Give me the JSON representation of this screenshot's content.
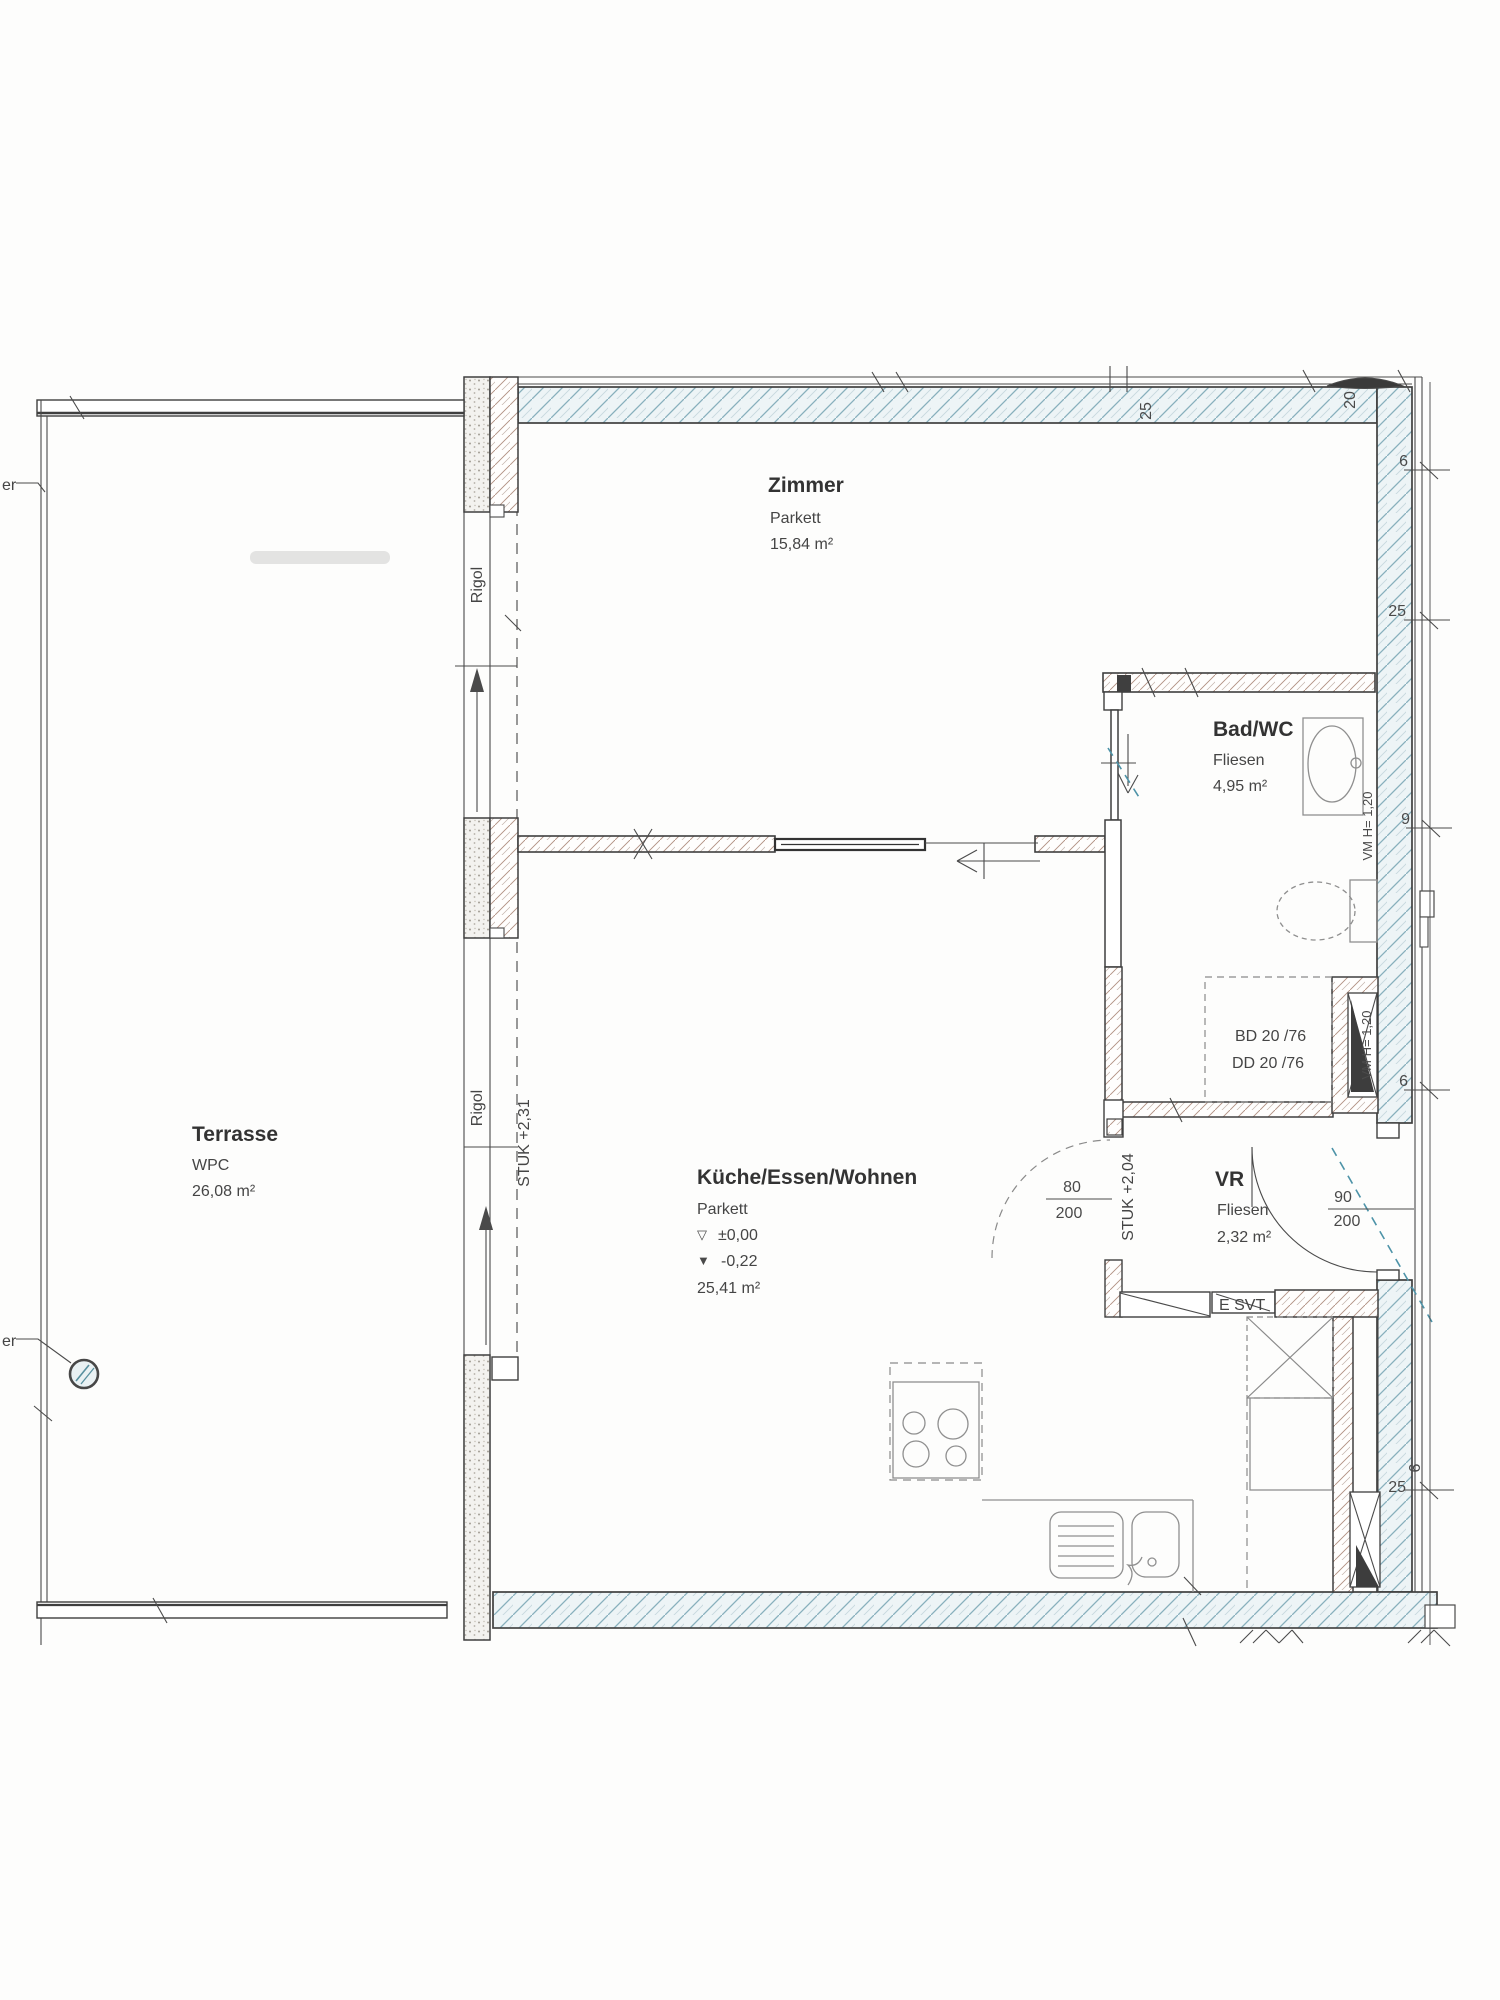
{
  "rooms": {
    "zimmer": {
      "name": "Zimmer",
      "floor": "Parkett",
      "area": "15,84 m²"
    },
    "bad_wc": {
      "name": "Bad/WC",
      "floor": "Fliesen",
      "area": "4,95 m²"
    },
    "terrasse": {
      "name": "Terrasse",
      "floor": "WPC",
      "area": "26,08 m²"
    },
    "kueche": {
      "name": "Küche/Essen/Wohnen",
      "floor": "Parkett",
      "level_symbol_top": "▽",
      "level_top": "±0,00",
      "level_symbol_bottom": "▼",
      "level_bottom": "-0,22",
      "area": "25,41 m²"
    },
    "vr": {
      "name": "VR",
      "floor": "Fliesen",
      "area": "2,32 m²"
    }
  },
  "doors": {
    "vr_west": {
      "width": "80",
      "height": "200"
    },
    "entrance": {
      "width": "90",
      "height": "200"
    }
  },
  "annotations": {
    "rigol_upper": "Rigol",
    "rigol_lower": "Rigol",
    "stuk_facade": "STUK +2,31",
    "stuk_vr": "STUK +2,04",
    "vm_niche": "VM H= 1,20",
    "vm_shaft": "VM H= 1,20",
    "tub_line1": "BD 20 /76",
    "tub_line2": "DD 20 /76",
    "e_svt": "E SVT",
    "edge_label_upper": "er",
    "edge_label_lower": "er"
  },
  "dimensions": {
    "top": [
      "25",
      "20"
    ],
    "right": [
      "6",
      "25",
      "9",
      "6",
      "6",
      "25"
    ]
  }
}
